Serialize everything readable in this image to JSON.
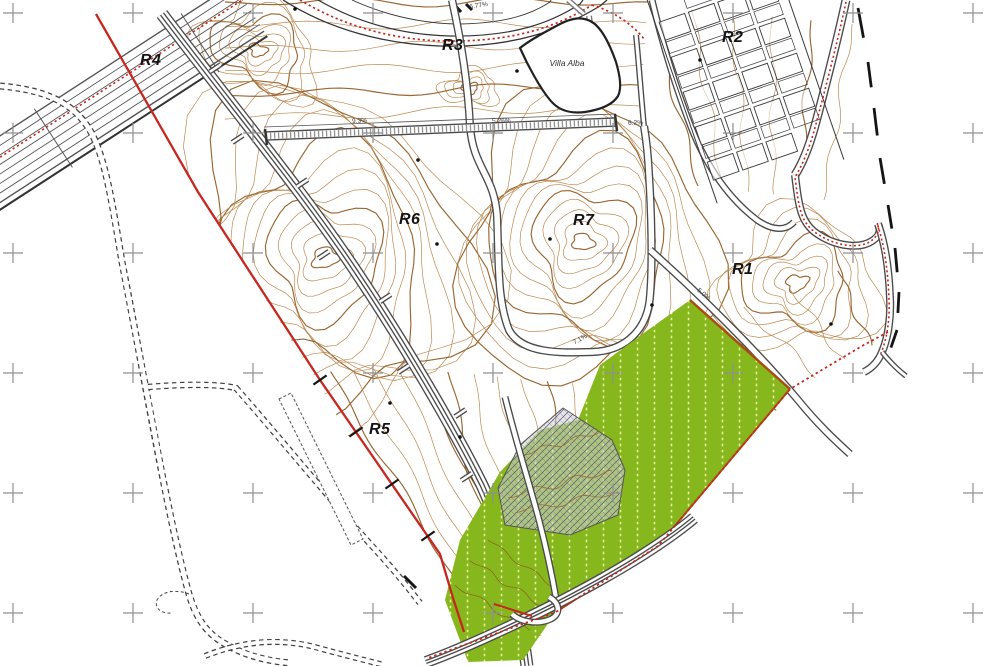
{
  "map": {
    "zone_labels": [
      {
        "text": "R1"
      },
      {
        "text": "R2"
      },
      {
        "text": "R3"
      },
      {
        "text": "R4"
      },
      {
        "text": "R5"
      },
      {
        "text": "R6"
      },
      {
        "text": "R7"
      }
    ],
    "place_labels": [
      {
        "text": "Villa Alba"
      }
    ],
    "grade_labels": [
      {
        "text": "6.77%"
      },
      {
        "text": "5.26%"
      },
      {
        "text": "9.3%"
      },
      {
        "text": "6.2%"
      },
      {
        "text": "7.1%"
      },
      {
        "text": "5.0%"
      }
    ],
    "colors": {
      "contour": "#bd8a52",
      "contour_dark": "#9a6631",
      "road": "#4a4a4a",
      "road_light": "#777777",
      "red": "#c62820",
      "brown_edge": "#a84c12",
      "green_fill": "#86b71c",
      "green_dot": "#e6f0a0",
      "gray_fill": "#cdced6",
      "hatch_line": "#5c5c70",
      "cross": "#8f8f8f",
      "black": "#151515"
    }
  }
}
